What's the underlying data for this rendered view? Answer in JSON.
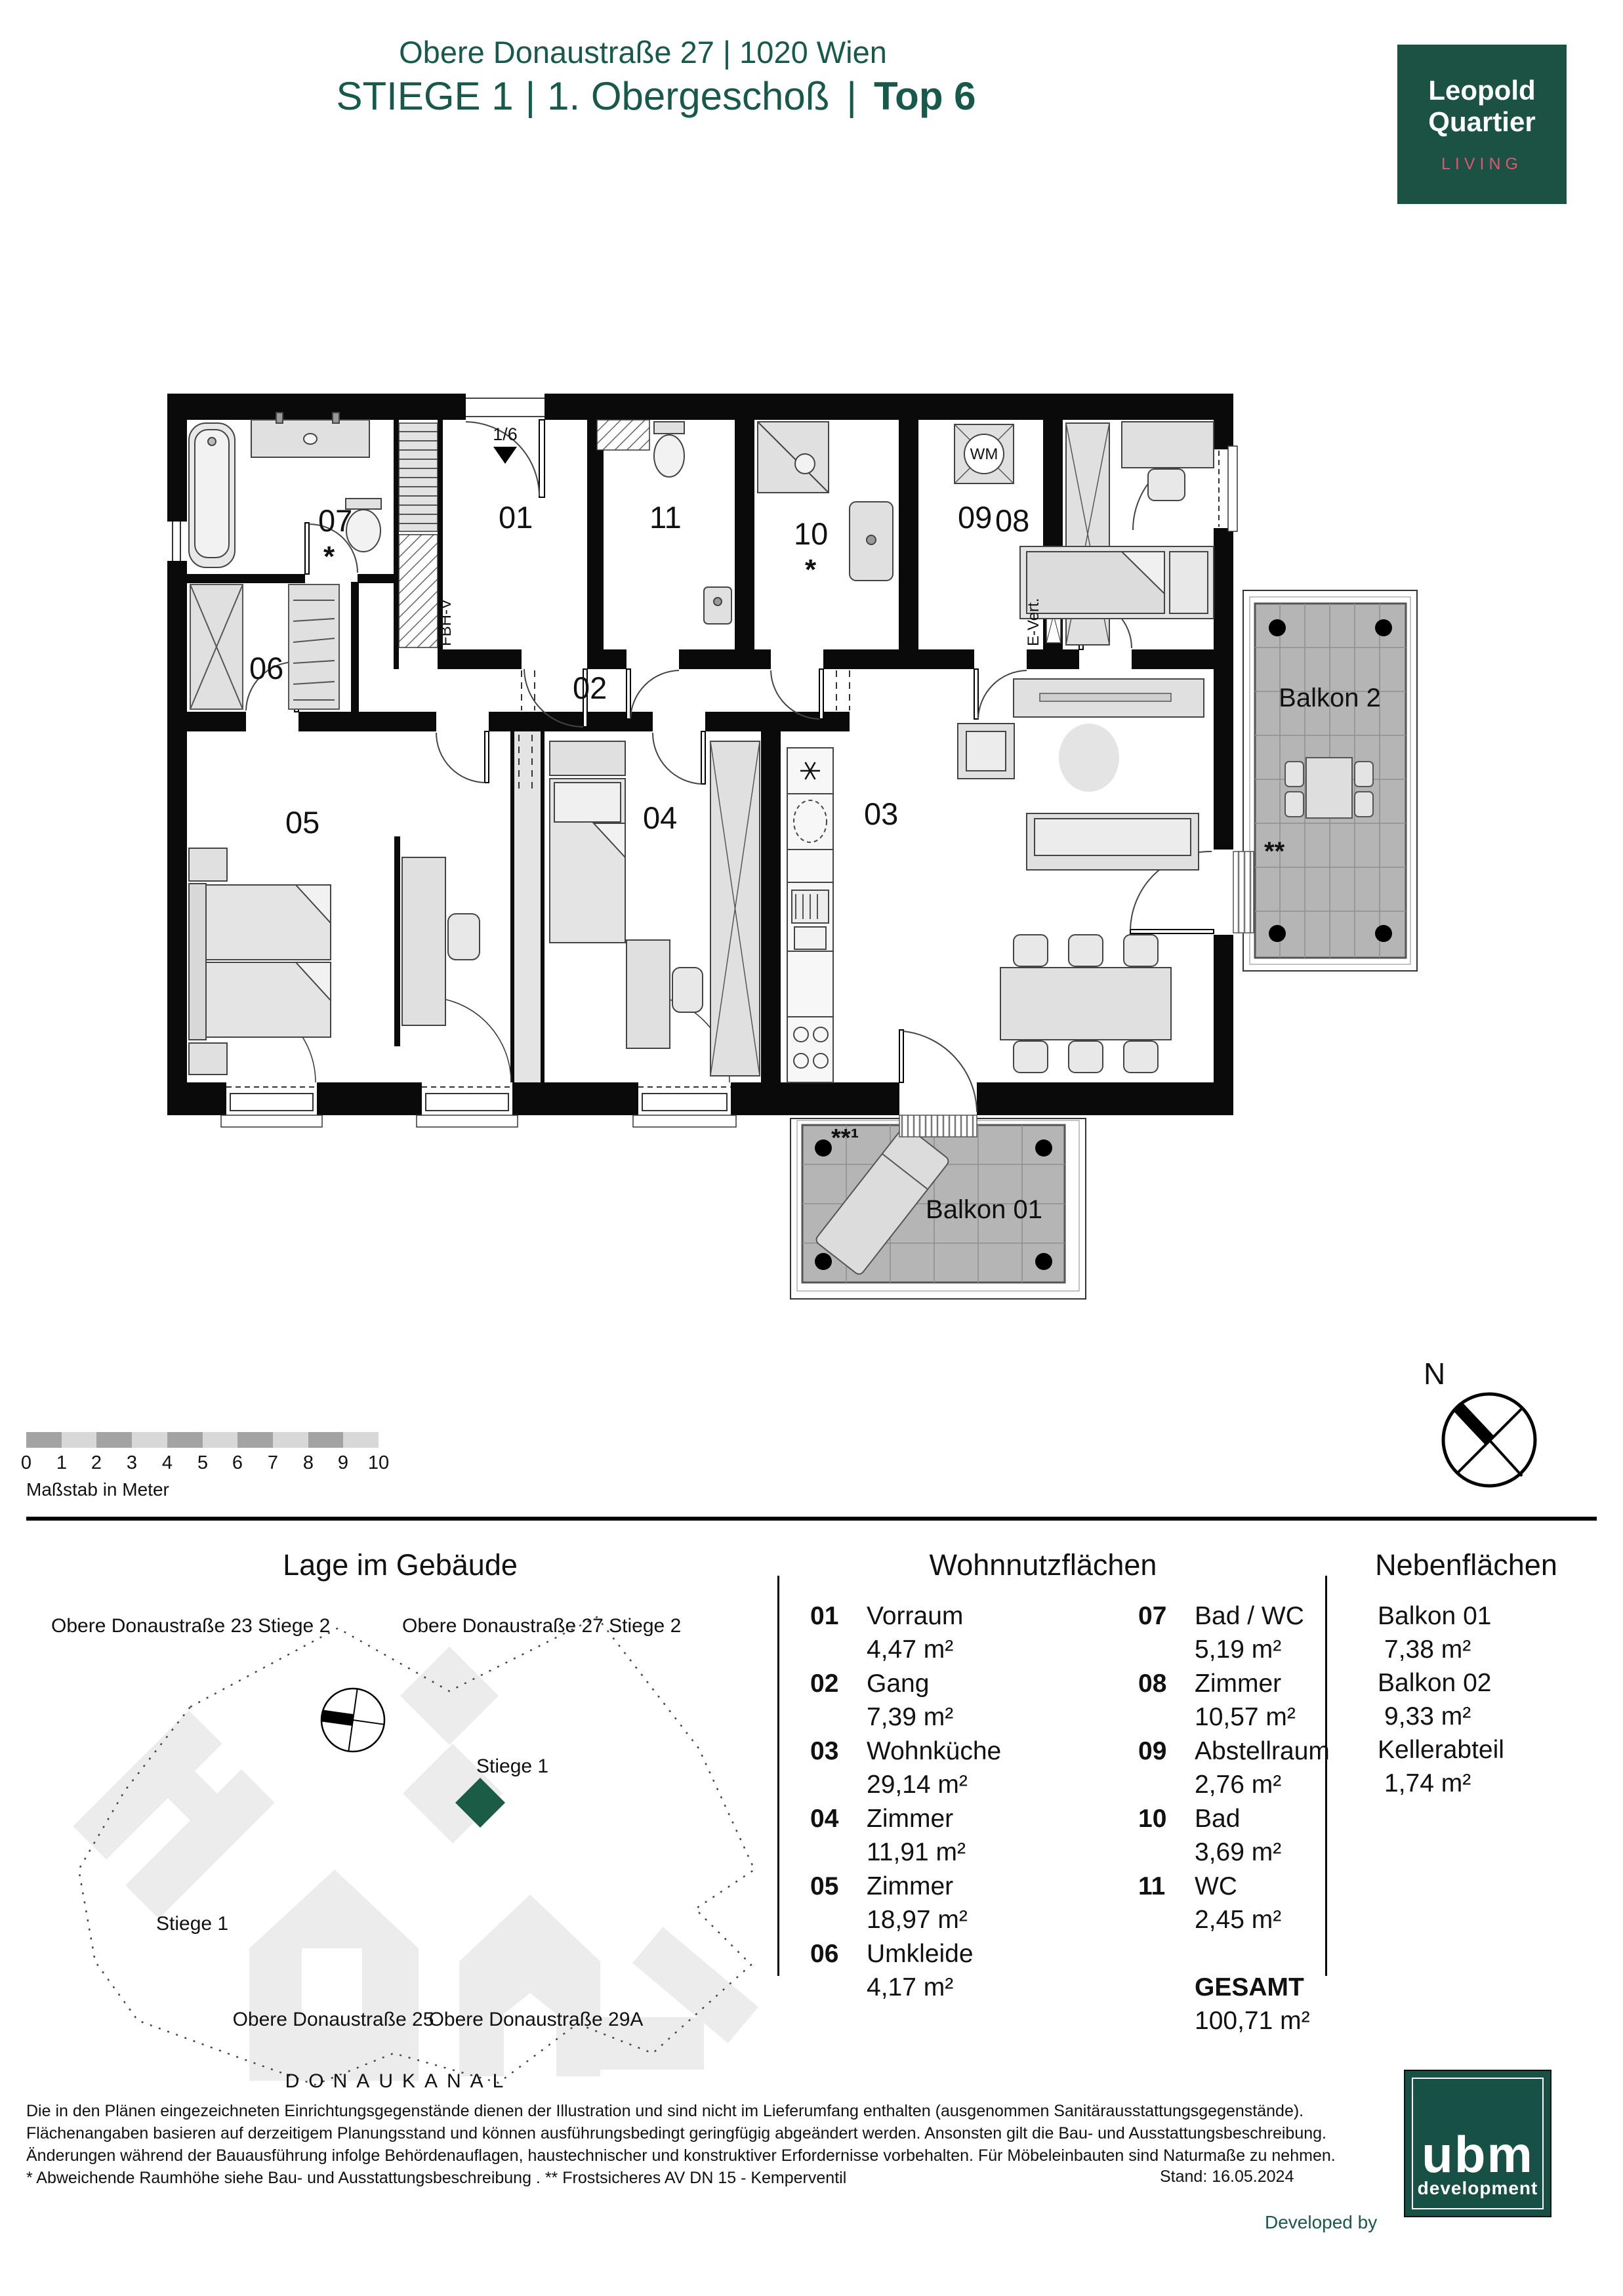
{
  "header": {
    "address": "Obere Donaustraße 27 | 1020 Wien",
    "stiege": "STIEGE 1",
    "sep": "|",
    "floor": "1. Obergeschoß",
    "top": "Top 6",
    "logo": {
      "line1": "Leopold",
      "line2": "Quartier",
      "tagline": "LIVING"
    }
  },
  "colors": {
    "brand_green": "#17594a",
    "logo_green": "#1b5243",
    "living_pink": "#e25572",
    "unit_marker_green": "#1a5c46"
  },
  "plan": {
    "rooms": {
      "r01": "01",
      "r02": "02",
      "r03": "03",
      "r04": "04",
      "r05": "05",
      "r06": "06",
      "r07": "07",
      "r08": "08",
      "r09": "09",
      "r10": "10",
      "r11": "11"
    },
    "star": "*",
    "balkon2_label": "Balkon 2",
    "balkon2_stars": "**",
    "balkon1_label": "Balkon 01",
    "balkon1_stars": "**¹",
    "wm_label": "WM",
    "entry_fraction": "1/6",
    "shaft_fbhv": "FBH-V",
    "shaft_evert": "E-Vert.",
    "north": "N"
  },
  "scalebar": {
    "ticks": [
      "0",
      "1",
      "2",
      "3",
      "4",
      "5",
      "6",
      "7",
      "8",
      "9",
      "10"
    ],
    "caption": "Maßstab in Meter"
  },
  "site": {
    "title": "Lage im Gebäude",
    "l23": "Obere Donaustraße 23 Stiege 2",
    "l27": "Obere Donaustraße 27 Stiege 2",
    "stiege1a": "Stiege 1",
    "stiege1b": "Stiege 1",
    "l25": "Obere Donaustraße 25",
    "l29a": "Obere Donaustraße 29A",
    "kanal": "DONAUKANAL"
  },
  "wohn": {
    "title": "Wohnnutzflächen",
    "col1": [
      {
        "num": "01",
        "name": "Vorraum",
        "area": "4,47 m²"
      },
      {
        "num": "02",
        "name": "Gang",
        "area": "7,39 m²"
      },
      {
        "num": "03",
        "name": "Wohnküche",
        "area": "29,14 m²"
      },
      {
        "num": "04",
        "name": "Zimmer",
        "area": "11,91 m²"
      },
      {
        "num": "05",
        "name": "Zimmer",
        "area": "18,97 m²"
      },
      {
        "num": "06",
        "name": "Umkleide",
        "area": "4,17 m²"
      }
    ],
    "col2": [
      {
        "num": "07",
        "name": "Bad / WC",
        "area": "5,19 m²"
      },
      {
        "num": "08",
        "name": "Zimmer",
        "area": "10,57 m²"
      },
      {
        "num": "09",
        "name": "Abstellraum",
        "area": "2,76 m²"
      },
      {
        "num": "10",
        "name": "Bad",
        "area": "3,69 m²"
      },
      {
        "num": "11",
        "name": "WC",
        "area": "2,45 m²"
      }
    ],
    "gesamt_label": "GESAMT",
    "gesamt_value": "100,71 m²"
  },
  "neben": {
    "title": "Nebenflächen",
    "items": [
      {
        "name": "Balkon 01",
        "area": "7,38 m²"
      },
      {
        "name": "Balkon 02",
        "area": "9,33 m²"
      },
      {
        "name": "Kellerabteil",
        "area": "1,74 m²"
      }
    ]
  },
  "footer": {
    "line1": "Die in den Plänen eingezeichneten Einrichtungsgegenstände dienen der Illustration und sind nicht im Lieferumfang enthalten (ausgenommen Sanitärausstattungsgegenstände).",
    "line2": "Flächenangaben basieren auf derzeitigem Planungsstand und können ausführungsbedingt geringfügig abgeändert werden. Ansonsten gilt die Bau- und Ausstattungsbeschreibung.",
    "line3": "Änderungen während der Bauausführung infolge Behördenauflagen, haustechnischer und konstruktiver Erfordernisse vorbehalten. Für Möbeleinbauten sind Naturmaße zu nehmen.",
    "line4": "* Abweichende Raumhöhe siehe Bau- und Ausstattungsbeschreibung . ** Frostsicheres AV DN 15 - Kemperventil",
    "stand": "Stand: 16.05.2024",
    "developed_by": "Developed by",
    "ubm_word": "ubm",
    "ubm_sub": "development"
  }
}
